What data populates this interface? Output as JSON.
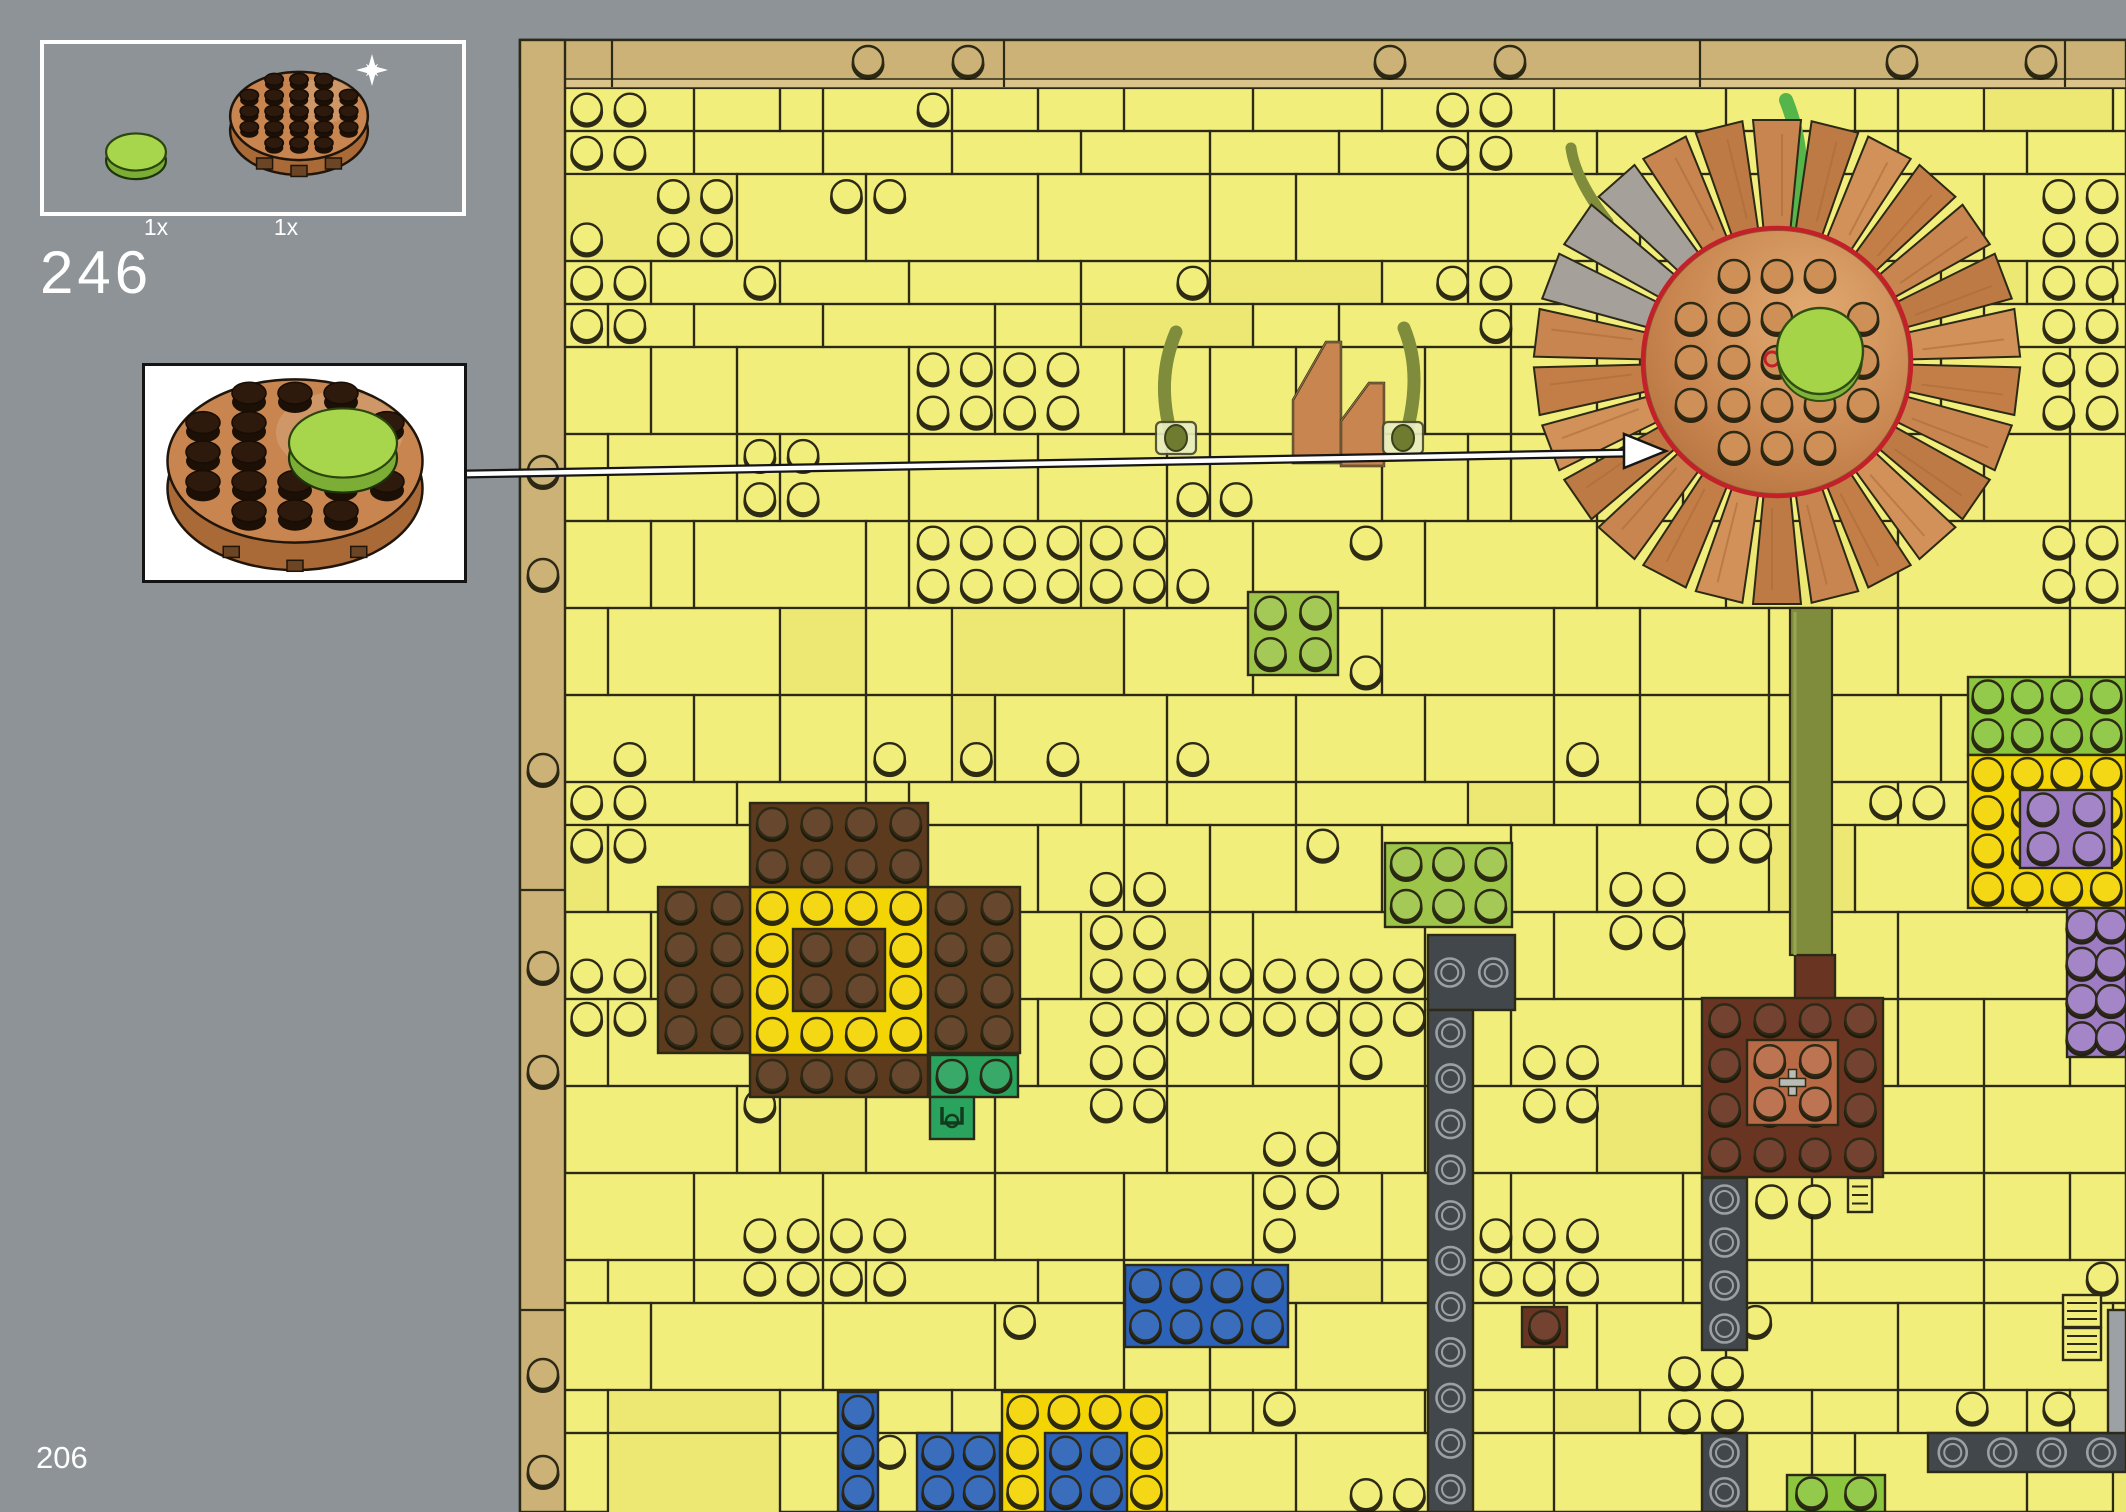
{
  "step": {
    "number": "246"
  },
  "page": {
    "number": "206"
  },
  "parts_callout": {
    "items": [
      {
        "count": "1x",
        "part": "green-round-tile-2x2"
      },
      {
        "count": "1x",
        "part": "nougat-round-plate-6x6",
        "badge": "sparkle-new-part"
      }
    ]
  },
  "subassembly_callout": {
    "part": "nougat-round-plate-with-green-round-tile"
  },
  "colors": {
    "pageBg": "#8d9396",
    "plateYellow": "#f2ee7c",
    "plateYellowAlt": "#ece873",
    "outline": "#2c2a16",
    "tan": "#ccb277",
    "tanLight": "#dbc48c",
    "brightYellow": "#f3d503",
    "yellow": "#f2ee7c",
    "blue": "#2c62b8",
    "darkBrown": "#5c3a1e",
    "redBrown": "#6a3422",
    "nougatLight": "#b76a45",
    "copper": "#c8854f",
    "copperDark": "#a96a38",
    "copperLight": "#daa066",
    "olive": "#7e8c3c",
    "brightGreen": "#55b44a",
    "green": "#29a35d",
    "lime": "#9dc54a",
    "mediumLime": "#8cc63e",
    "purple": "#9d7cc4",
    "darkGray": "#42474c",
    "ringGray": "#9aa0a4",
    "lightGray": "#9ba1a5",
    "red": "#c3202a",
    "white": "#ffffff"
  },
  "arrow": {
    "x1": 467,
    "y1": 474,
    "x2": 1630,
    "y2": 453,
    "tipx": 1666,
    "tipy": 451
  },
  "build": {
    "area": {
      "x": 520,
      "y": 40,
      "w": 1606,
      "h": 1472
    },
    "grid": {
      "pitch": 43.3,
      "ox": 565,
      "oy": 88
    },
    "border_studs": {
      "top_y": 62,
      "top_xs": [
        868,
        968,
        1390,
        1510,
        1902,
        2041
      ],
      "left_x": 543,
      "left_ys": [
        472,
        575,
        770,
        968,
        1072,
        1375,
        1472
      ],
      "top_dividers": [
        612,
        1004,
        1700,
        2065
      ],
      "left_dividers": [
        470,
        890,
        1310
      ]
    },
    "regions": [
      {
        "name": "sunflower-mosaic-yellow-ring",
        "x": 750,
        "y": 887,
        "w": 178,
        "h": 168,
        "color": "brightYellow",
        "studs": [
          4,
          4
        ]
      },
      {
        "name": "sunflower-mosaic-center",
        "x": 793,
        "y": 929,
        "w": 92,
        "h": 82,
        "color": "darkBrown",
        "studs": [
          2,
          2
        ]
      },
      {
        "name": "sunflower-mosaic-top",
        "x": 750,
        "y": 803,
        "w": 178,
        "h": 84,
        "color": "darkBrown",
        "studs": [
          4,
          2
        ]
      },
      {
        "name": "sunflower-mosaic-left",
        "x": 658,
        "y": 887,
        "w": 92,
        "h": 166,
        "color": "darkBrown",
        "studs": [
          2,
          4
        ]
      },
      {
        "name": "sunflower-mosaic-right",
        "x": 928,
        "y": 887,
        "w": 92,
        "h": 166,
        "color": "darkBrown",
        "studs": [
          2,
          4
        ]
      },
      {
        "name": "sunflower-mosaic-bottom",
        "x": 750,
        "y": 1055,
        "w": 178,
        "h": 42,
        "color": "darkBrown",
        "studs": [
          4,
          1
        ]
      },
      {
        "name": "green-plate-2x1",
        "x": 930,
        "y": 1055,
        "w": 88,
        "h": 42,
        "color": "green",
        "studs": [
          2,
          1
        ]
      },
      {
        "name": "green-clip-1x1",
        "x": 930,
        "y": 1097,
        "w": 44,
        "h": 42,
        "color": "green",
        "clip": true
      },
      {
        "name": "blue-brick-4x2",
        "x": 1125,
        "y": 1265,
        "w": 163,
        "h": 82,
        "color": "blue",
        "studs": [
          4,
          2
        ]
      },
      {
        "name": "blue-brick-1x3",
        "x": 838,
        "y": 1392,
        "w": 40,
        "h": 120,
        "color": "blue",
        "studs": [
          1,
          3
        ]
      },
      {
        "name": "blue-brick-2x2-a",
        "x": 917,
        "y": 1433,
        "w": 83,
        "h": 79,
        "color": "blue",
        "studs": [
          2,
          2
        ]
      },
      {
        "name": "yellow-bricks-u",
        "x": 1002,
        "y": 1392,
        "w": 165,
        "h": 120,
        "color": "brightYellow",
        "studs": [
          4,
          3
        ]
      },
      {
        "name": "blue-brick-2x2-b",
        "x": 1045,
        "y": 1433,
        "w": 82,
        "h": 79,
        "color": "blue",
        "studs": [
          2,
          2
        ]
      },
      {
        "name": "darkgray-plate-2x1",
        "x": 1428,
        "y": 935,
        "w": 87,
        "h": 75,
        "color": "darkGray",
        "ring": [
          2,
          1
        ]
      },
      {
        "name": "darkgray-column-left",
        "x": 1428,
        "y": 1010,
        "w": 45,
        "h": 502,
        "color": "darkGray",
        "ring": [
          1,
          11
        ]
      },
      {
        "name": "darkgray-column-right-a",
        "x": 1702,
        "y": 1178,
        "w": 45,
        "h": 172,
        "color": "darkGray",
        "ring": [
          1,
          4
        ]
      },
      {
        "name": "darkgray-column-right-b",
        "x": 1702,
        "y": 1433,
        "w": 45,
        "h": 79,
        "color": "darkGray",
        "ring": [
          1,
          2
        ]
      },
      {
        "name": "brown-tile-1x1",
        "x": 1522,
        "y": 1307,
        "w": 45,
        "h": 40,
        "color": "redBrown",
        "studs": [
          1,
          1
        ]
      },
      {
        "name": "brown-block-4x4",
        "x": 1702,
        "y": 998,
        "w": 181,
        "h": 179,
        "color": "redBrown",
        "studs": [
          4,
          4
        ]
      },
      {
        "name": "nougat-bracket-2x2",
        "x": 1747,
        "y": 1040,
        "w": 91,
        "h": 85,
        "color": "nougatLight",
        "studs": [
          2,
          2
        ],
        "axle": true
      },
      {
        "name": "brown-stem-1x1",
        "x": 1795,
        "y": 955,
        "w": 40,
        "h": 43,
        "color": "redBrown"
      },
      {
        "name": "lime-plate-2x2",
        "x": 1248,
        "y": 592,
        "w": 90,
        "h": 83,
        "color": "lime",
        "studs": [
          2,
          2
        ]
      },
      {
        "name": "lime-plate-3x2",
        "x": 1385,
        "y": 843,
        "w": 127,
        "h": 84,
        "color": "lime",
        "studs": [
          3,
          2
        ]
      },
      {
        "name": "green-band-right",
        "x": 1968,
        "y": 677,
        "w": 158,
        "h": 78,
        "color": "mediumLime",
        "studs": [
          4,
          2
        ]
      },
      {
        "name": "yellow-block-right",
        "x": 1968,
        "y": 755,
        "w": 158,
        "h": 153,
        "color": "brightYellow",
        "studs": [
          4,
          4
        ]
      },
      {
        "name": "purple-brick-2x2",
        "x": 2020,
        "y": 790,
        "w": 92,
        "h": 78,
        "color": "purple",
        "studs": [
          2,
          2
        ]
      },
      {
        "name": "purple-block-right",
        "x": 2067,
        "y": 908,
        "w": 59,
        "h": 149,
        "color": "purple",
        "studs": [
          2,
          4
        ]
      },
      {
        "name": "darkgray-bar-bottom",
        "x": 1928,
        "y": 1433,
        "w": 198,
        "h": 39,
        "color": "darkGray",
        "ring": [
          4,
          1
        ]
      },
      {
        "name": "lightgray-edge",
        "x": 2108,
        "y": 1310,
        "w": 18,
        "h": 123,
        "color": "lightGray"
      },
      {
        "name": "lime-plate-bottom",
        "x": 1787,
        "y": 1475,
        "w": 98,
        "h": 37,
        "color": "mediumLime",
        "studs": [
          2,
          1
        ]
      },
      {
        "name": "grille-1x1-a",
        "x": 2063,
        "y": 1295,
        "w": 38,
        "h": 32,
        "color": "yellow",
        "grille": true
      },
      {
        "name": "grille-1x1-b",
        "x": 2063,
        "y": 1328,
        "w": 38,
        "h": 32,
        "color": "yellow",
        "grille": true
      },
      {
        "name": "ladder-1x1",
        "x": 1848,
        "y": 1178,
        "w": 24,
        "h": 34,
        "color": "yellow",
        "grille": true
      }
    ],
    "stud_clusters": [
      {
        "x": 1663,
        "y": 1352,
        "cols": 2,
        "rows": 2,
        "pitch": 43
      },
      {
        "x": 1750,
        "y": 1180,
        "cols": 2,
        "rows": 1,
        "pitch": 43
      }
    ],
    "stud_exclusions": [
      {
        "x": 1510,
        "y": 95,
        "w": 540,
        "h": 530
      },
      {
        "x": 1775,
        "y": 590,
        "w": 70,
        "h": 370
      },
      {
        "x": 1125,
        "y": 315,
        "w": 340,
        "h": 165
      },
      {
        "x": 1553,
        "y": 125,
        "w": 75,
        "h": 115
      },
      {
        "x": 1653,
        "y": 1342,
        "w": 105,
        "h": 100
      },
      {
        "x": 1740,
        "y": 1168,
        "w": 105,
        "h": 55
      }
    ],
    "slopes": [
      {
        "name": "copper-slope-left",
        "points": "1293,463 1293,400 1326,342 1341,342 1341,463"
      },
      {
        "name": "copper-slope-right",
        "points": "1341,466 1341,421 1369,383 1384,383 1384,466"
      }
    ],
    "stems": [
      {
        "name": "vine-stem-left",
        "d": "M 1176,332 C 1162,365 1160,400 1174,445",
        "w": 13,
        "color": "olive"
      },
      {
        "name": "vine-stem-right",
        "d": "M 1404,328 C 1418,362 1417,400 1403,445",
        "w": 13,
        "color": "olive"
      }
    ],
    "nuts": [
      {
        "x": 1156,
        "y": 422
      },
      {
        "x": 1383,
        "y": 422
      }
    ],
    "vines": [
      {
        "d": "M 1793,220 C 1806,175 1800,135 1786,100",
        "w": 14,
        "color": "brightGreen"
      },
      {
        "d": "M 1742,215 C 1731,185 1722,163 1717,138",
        "w": 11,
        "color": "brightGreen"
      },
      {
        "d": "M 1608,222 C 1588,196 1574,170 1571,148",
        "w": 11,
        "color": "olive"
      }
    ],
    "flower": {
      "cx": 1777,
      "cy": 362,
      "outerR": 242,
      "innerR": 128,
      "petals": 26,
      "grayPetals": [
        21,
        22,
        23
      ],
      "greenCx": 1820,
      "greenCy": 353,
      "greenR": 43,
      "redRingR": 134,
      "stem": {
        "x": 1790,
        "y": 608,
        "w": 42,
        "h": 347
      }
    }
  }
}
